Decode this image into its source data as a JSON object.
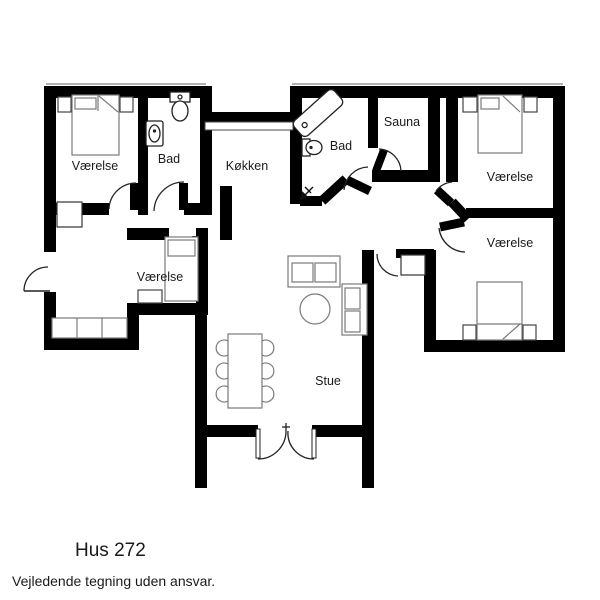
{
  "footer": {
    "title": "Hus 272",
    "disclaimer": "Vejledende tegning uden ansvar."
  },
  "rooms": [
    {
      "id": "bedroom-top-left",
      "label": "Værelse"
    },
    {
      "id": "bathroom-left",
      "label": "Bad"
    },
    {
      "id": "kitchen",
      "label": "Køkken"
    },
    {
      "id": "bathroom-middle",
      "label": "Bad"
    },
    {
      "id": "sauna",
      "label": "Sauna"
    },
    {
      "id": "bedroom-top-right",
      "label": "Værelse"
    },
    {
      "id": "bedroom-mid-right",
      "label": "Værelse"
    },
    {
      "id": "bedroom-small",
      "label": "Værelse"
    },
    {
      "id": "living-room",
      "label": "Stue"
    }
  ],
  "colors": {
    "walls": "#000000",
    "furniture_outline": "#7a7a7a",
    "fixture_outline": "#222222",
    "roof_hairline": "#999999",
    "text": "#1a1a1a"
  }
}
